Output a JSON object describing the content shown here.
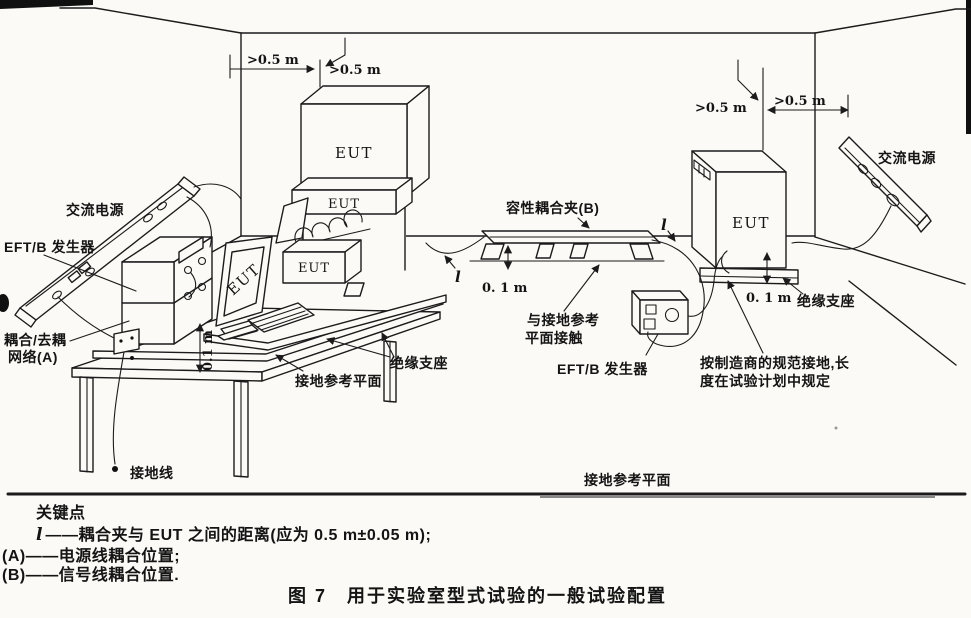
{
  "page": {
    "background": "#fbfaf6",
    "ink": "#1b1b1b"
  },
  "labels": {
    "ac_power": "交流电源",
    "eftb_generator": "EFT/B 发生器",
    "cdn_line1": "耦合/去耦",
    "cdn_line2": "网络(A)",
    "ground_wire": "接地线",
    "ground_ref_plane": "接地参考平面",
    "insulating_support": "绝缘支座",
    "capacitive_clamp": "容性耦合夹(B)",
    "contact_line1": "与接地参考",
    "contact_line2": "平面接触",
    "mfr_ground_line1": "按制造商的规范接地,长",
    "mfr_ground_line2": "度在试验计划中规定",
    "eut": "EUT",
    "dim_gt_05m": ">0.5 m",
    "dim_01m": "0. 1 m",
    "dim_01m_rotated": "0.1 m",
    "l_symbol": "l"
  },
  "notes": {
    "title": "关键点",
    "item_l_symbol": "l",
    "item_l_text": "——耦合夹与 EUT 之间的距离(应为 0.5 m±0.05 m);",
    "item_a_prefix": "(A)",
    "item_a_text": "——电源线耦合位置;",
    "item_b_prefix": "(B)",
    "item_b_text": "——信号线耦合位置.",
    "caption": "图 7　用于实验室型式试验的一般试验配置"
  }
}
